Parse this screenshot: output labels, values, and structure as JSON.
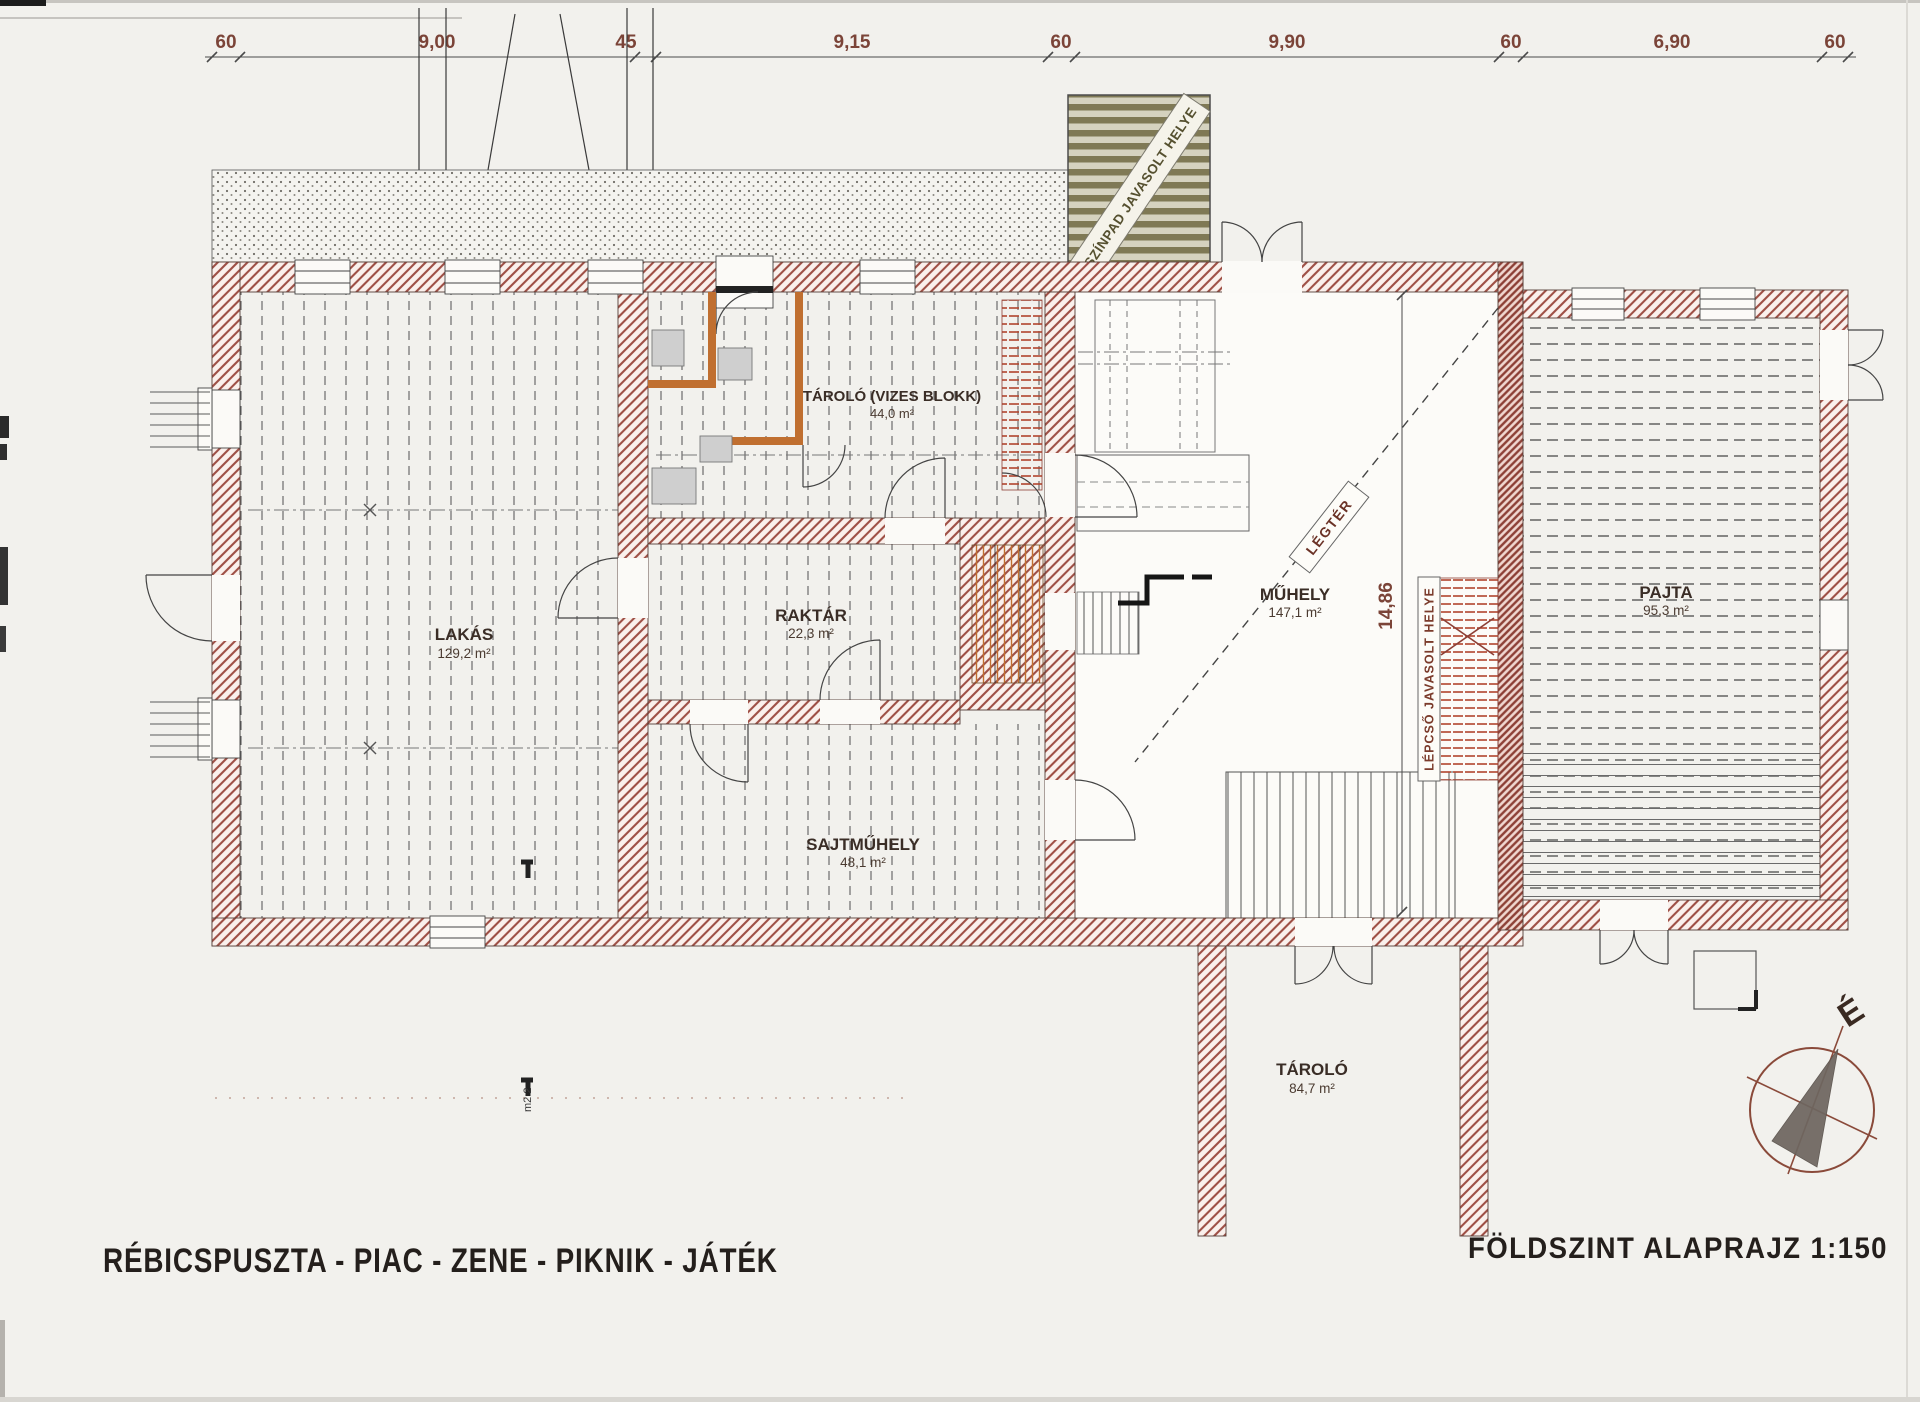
{
  "sheet": {
    "project_title": "RÉBICSPUSZTA  -  PIAC  -  ZENE  -  PIKNIK  -  JÁTÉK",
    "drawing_title": "FÖLDSZINT ALAPRAJZ  1:150"
  },
  "dimensions": {
    "top_chain": [
      "60",
      "9,00",
      "45",
      "9,15",
      "60",
      "9,90",
      "60",
      "6,90",
      "60"
    ],
    "vertical_depth": "14,86",
    "section_mark": "m2 2"
  },
  "rooms": [
    {
      "id": "lakas",
      "name": "LAKÁS",
      "area": "129,2 m²"
    },
    {
      "id": "tarolo-vizes",
      "name": "TÁROLÓ (VIZES BLOKK)",
      "area": "44,0 m²"
    },
    {
      "id": "raktar",
      "name": "RAKTÁR",
      "area": "22,3 m²"
    },
    {
      "id": "sajtmuhely",
      "name": "SAJTMŰHELY",
      "area": "48,1 m²"
    },
    {
      "id": "muhely",
      "name": "MŰHELY",
      "area": "147,1 m²"
    },
    {
      "id": "pajta",
      "name": "PAJTA",
      "area": "95,3 m²"
    },
    {
      "id": "tarolo",
      "name": "TÁROLÓ",
      "area": "84,7 m²"
    }
  ],
  "annotations": {
    "stage_proposed": "SZÍNPAD JAVASOLT HELYE",
    "airspace": "LÉGTÉR",
    "stairs_proposed": "LÉPCSŐ JAVASOLT HELYE",
    "north": "É"
  },
  "colors": {
    "paper": "#f2f1ed",
    "wall_hatch": "#9e4f45",
    "orange_partition": "#c06f30",
    "stage_stripe": "#7f7955",
    "dimension_text": "#7b4438",
    "label_text": "#3a2d26",
    "stair_red": "#a34a31",
    "compass": "#8a4a3a"
  }
}
